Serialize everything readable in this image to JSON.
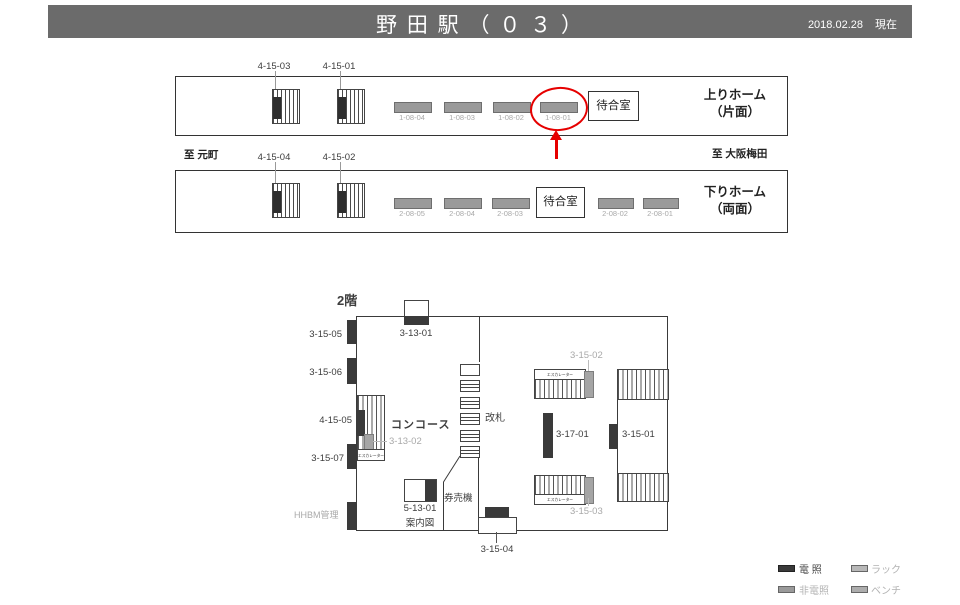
{
  "colors": {
    "header_bg": "#6b6b6b",
    "accent_red": "#e60000",
    "lit_dark": "#3a3a3a",
    "unlit_gray": "#9a9a9a",
    "gray_text": "#a9a9a9"
  },
  "header": {
    "title": "野 田 駅 （ ０ ３ ）",
    "date": "2018.02.28",
    "status": "現在"
  },
  "route": {
    "to_left": "至 元町",
    "to_right": "至 大阪梅田"
  },
  "platform_up": {
    "name_line1": "上りホーム",
    "name_line2": "（片面）",
    "waiting_room": "待合室",
    "signboards": [
      {
        "id": "4-15-03"
      },
      {
        "id": "4-15-01"
      }
    ],
    "posters": [
      {
        "id": "1-08-04"
      },
      {
        "id": "1-08-03"
      },
      {
        "id": "1-08-02"
      },
      {
        "id": "1-08-01"
      }
    ],
    "highlighted_poster": "1-08-01"
  },
  "platform_down": {
    "name_line1": "下りホーム",
    "name_line2": "（両面）",
    "waiting_room": "待合室",
    "signboards": [
      {
        "id": "4-15-04"
      },
      {
        "id": "4-15-02"
      }
    ],
    "posters_left": [
      {
        "id": "2-08-05"
      },
      {
        "id": "2-08-04"
      },
      {
        "id": "2-08-03"
      }
    ],
    "posters_right": [
      {
        "id": "2-08-02"
      },
      {
        "id": "2-08-01"
      }
    ]
  },
  "concourse": {
    "floor": "2階",
    "area": "コンコース",
    "gate": "改札",
    "ticket_machine": "券売機",
    "escalator": "エスカレーター",
    "manage": "HHBM管理",
    "info_line1": "5-13-01",
    "info_line2": "案内図",
    "labels": {
      "l31301": "3-13-01",
      "l31505": "3-15-05",
      "l31506": "3-15-06",
      "l41505": "4-15-05",
      "l31302": "3-13-02",
      "l31507": "3-15-07",
      "l31504": "3-15-04",
      "l31502": "3-15-02",
      "l31701": "3-17-01",
      "l31501": "3-15-01",
      "l31503": "3-15-03"
    }
  },
  "legend": {
    "lit": "電 照",
    "rack": "ラック",
    "unlit": "非電照",
    "bench": "ベンチ"
  }
}
